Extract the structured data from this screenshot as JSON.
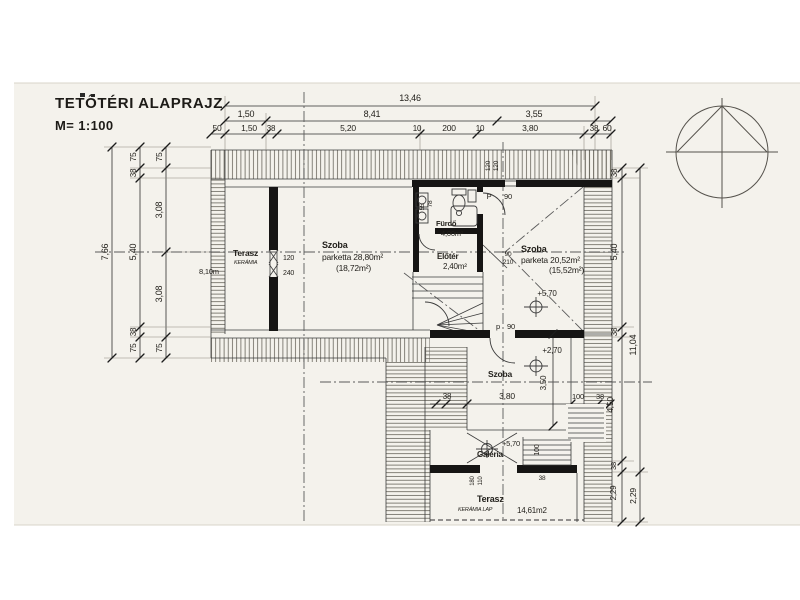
{
  "title": {
    "text": "TETŐTÉRI ALAPRAJZ",
    "scale": "M= 1:100"
  },
  "dims": {
    "top_total": "13,46",
    "top_row2": [
      "1,50",
      "8,41",
      "3,55"
    ],
    "top_row3": [
      "50",
      "1,50",
      "38",
      "5,20",
      "10",
      "200",
      "10",
      "3,80",
      "38",
      "60"
    ],
    "left_total": "7,66",
    "left_mid": [
      "75",
      "38",
      "5,40",
      "38",
      "75"
    ],
    "left_inner": [
      "75",
      "3,08",
      "3,08",
      "75"
    ],
    "right_inner": [
      "38",
      "5,40",
      "38",
      "4,50",
      "38",
      "2,29"
    ],
    "right_outer": [
      "11,04",
      "2,29"
    ],
    "lower": {
      "w38a": "38",
      "w380": "3,80",
      "w100": "100",
      "w38b": "38",
      "h350": "3,50",
      "g100": "100",
      "g38": "38"
    }
  },
  "rooms": {
    "terasz1": {
      "name": "Terasz",
      "finish": "KERÁMIA",
      "area": "8,10m"
    },
    "szoba1": {
      "name": "Szoba",
      "line2": "parketta 28,80m²",
      "line3": "(18,72m²)"
    },
    "furdo": {
      "name": "Fürdő",
      "area": "4,00m²"
    },
    "eloter": {
      "name": "Előtér",
      "area": "2,40m²"
    },
    "szoba2": {
      "name": "Szoba",
      "line2": "parketa 20,52m²",
      "line3": "(15,52m²)"
    },
    "szoba3": {
      "name": "Szoba"
    },
    "galeria": {
      "name": "Galéria"
    },
    "terasz2": {
      "name": "Terasz",
      "finish": "KERÁMIA LAP",
      "area": "14,61m2"
    }
  },
  "levels": {
    "l570a": "+5,70",
    "l270": "+2,70",
    "l570b": "+5,70"
  },
  "openings": {
    "door_top_p": "P",
    "door_top_90": "90",
    "door_low_p": "p",
    "door_low_90": "90",
    "d90": "90",
    "d210": "210",
    "win120": "120",
    "win240": "240",
    "wtop120a": "120",
    "wtop120b": "120",
    "wg180": "180",
    "wg110": "110",
    "b55": "55",
    "b78": "78"
  },
  "colors": {
    "paper": "#f4f2ec",
    "ink": "#24221d",
    "wall": "#161514"
  }
}
